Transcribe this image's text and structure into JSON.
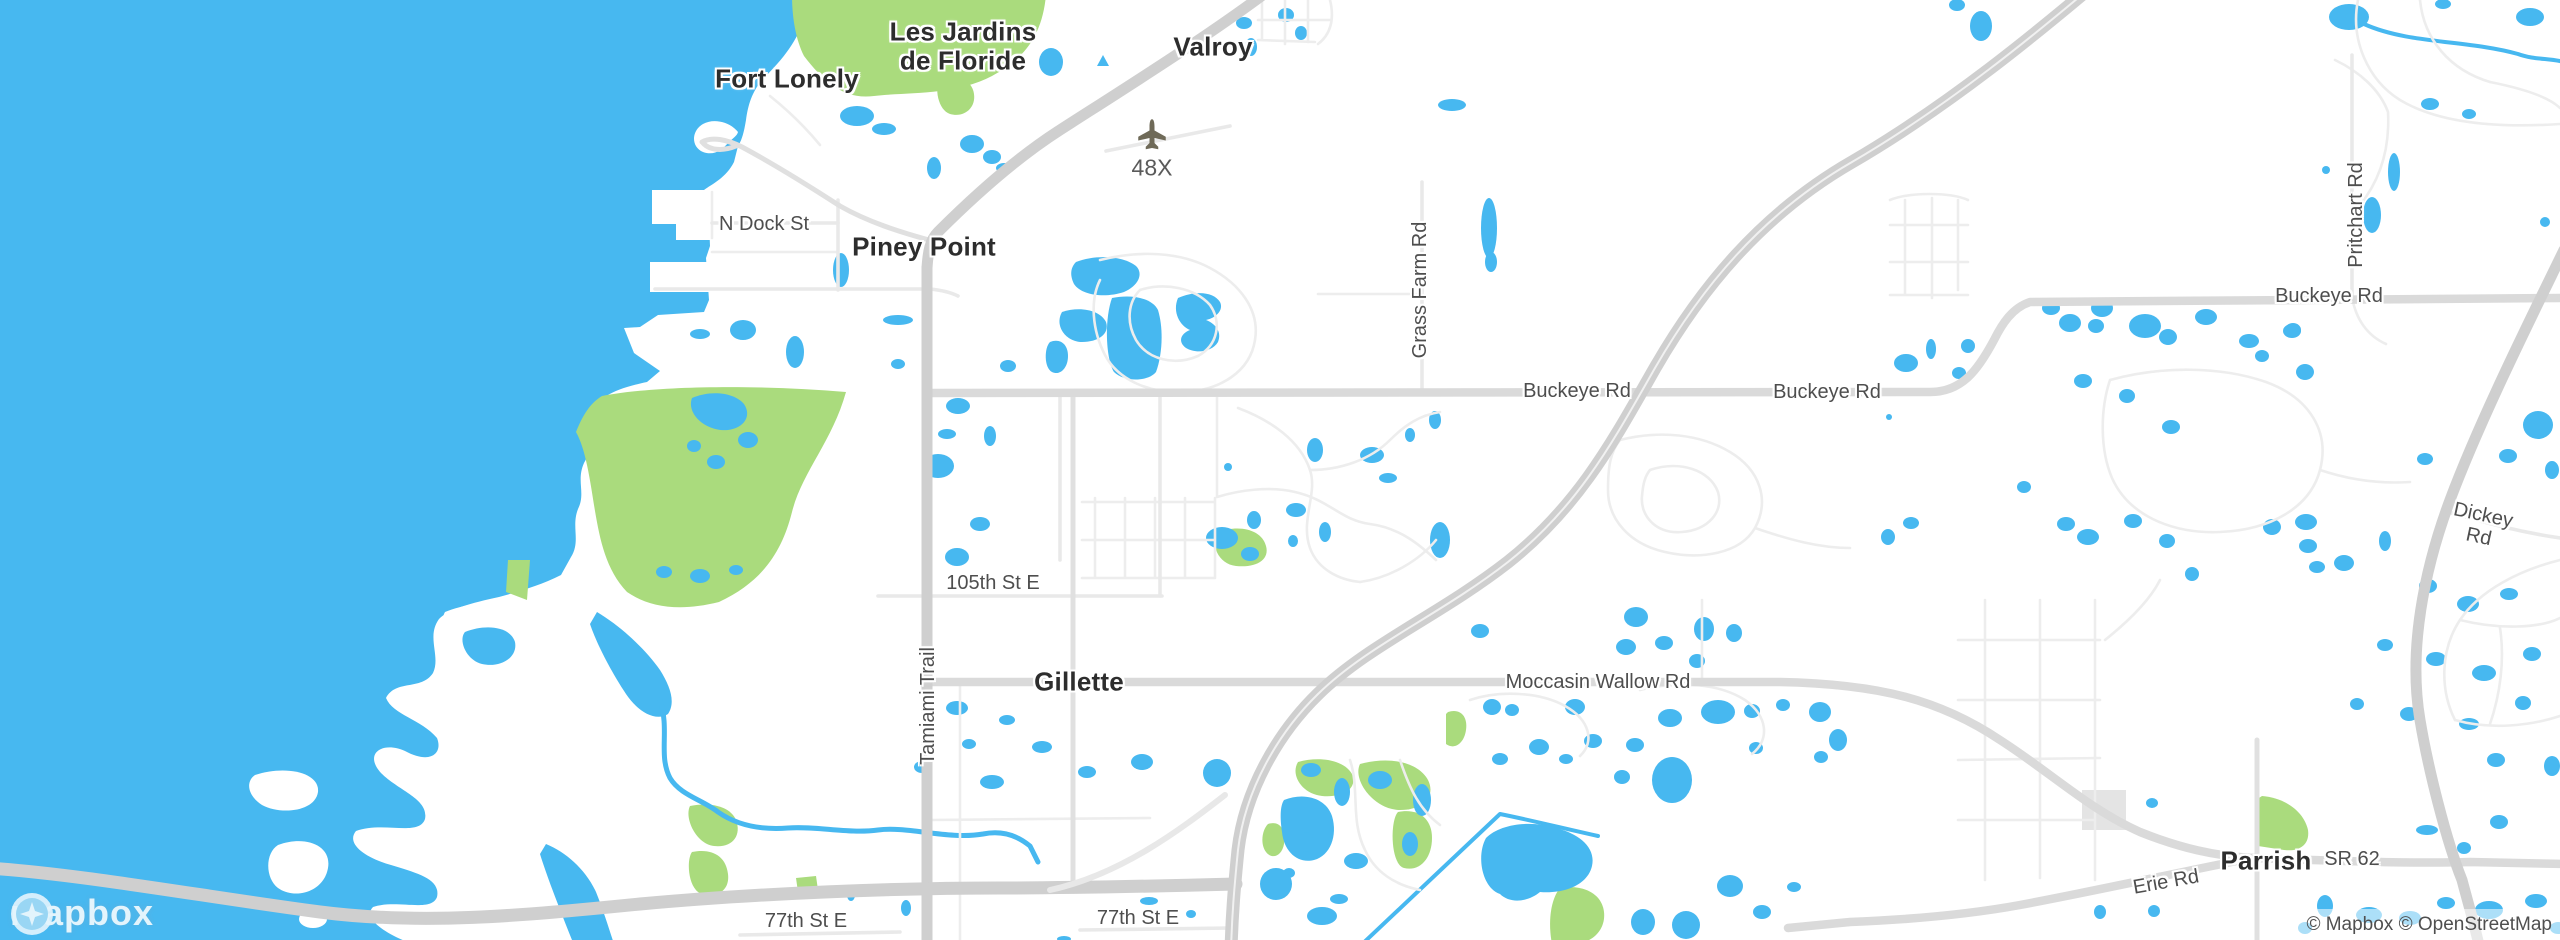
{
  "colors": {
    "water": "#47b8f0",
    "park": "#aadb7d",
    "land": "#ffffff",
    "road_major": "#cfcfcf",
    "road_art": "#dadada",
    "road_minor": "#e9e9e9",
    "road_minor2": "#ededed",
    "place": "#2d2d2d",
    "roadlbl": "#4e4e4e"
  },
  "labels": {
    "les_jardins": {
      "text": "Les Jardins\nde Floride"
    },
    "fort_lonely": {
      "text": "Fort Lonely"
    },
    "valroy": {
      "text": "Valroy"
    },
    "piney_point": {
      "text": "Piney Point"
    },
    "gillette": {
      "text": "Gillette"
    },
    "parrish": {
      "text": "Parrish"
    },
    "n_dock_st": {
      "text": "N Dock St"
    },
    "grass_farm_rd": {
      "text": "Grass Farm Rd"
    },
    "buckeye_rd_w": {
      "text": "Buckeye Rd"
    },
    "buckeye_rd_mid": {
      "text": "Buckeye Rd"
    },
    "buckeye_rd_e": {
      "text": "Buckeye Rd"
    },
    "pritchart_rd": {
      "text": "Pritchart Rd"
    },
    "dickey_rd": {
      "text": "Dickey Rd"
    },
    "st_105th": {
      "text": "105th St E"
    },
    "tamiami_trail": {
      "text": "Tamiami Trail"
    },
    "moccasin_wallow_rd": {
      "text": "Moccasin Wallow Rd"
    },
    "erie_rd": {
      "text": "Erie Rd"
    },
    "sr_62": {
      "text": "SR 62"
    },
    "st_77th_w": {
      "text": "77th St E"
    },
    "st_77th_e": {
      "text": "77th St E"
    },
    "airport_48x": {
      "text": "48X"
    }
  },
  "watermark": {
    "text": "mapbox"
  },
  "attribution": {
    "text": "© Mapbox © OpenStreetMap"
  }
}
